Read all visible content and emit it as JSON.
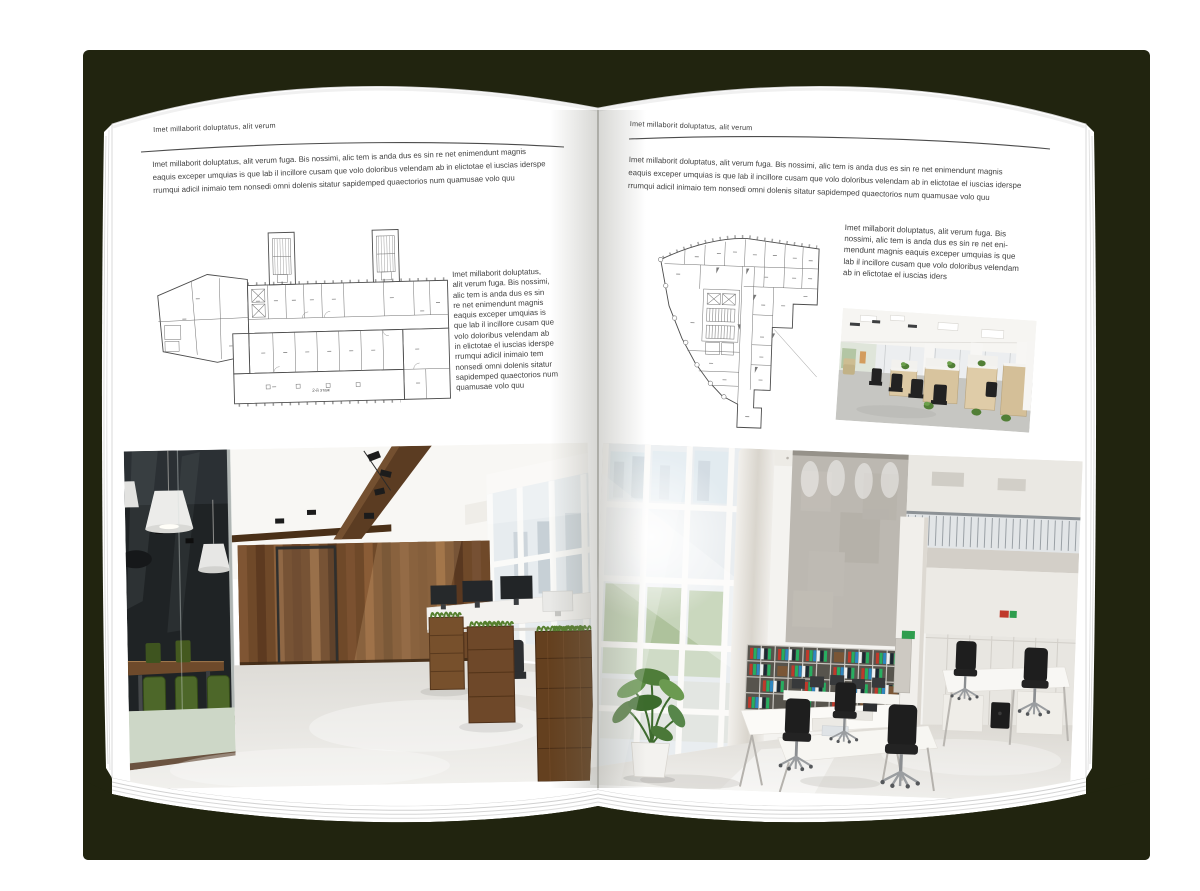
{
  "mockup": {
    "cover_color": "#21240f",
    "page_color": "#ffffff",
    "background_color": "#ffffff"
  },
  "left_page": {
    "header": "Imet millaborit doluptatus, alit verum",
    "intro_lines": [
      "Imet millaborit doluptatus, alit verum fuga. Bis nossimi, alic tem is anda dus es sin re net enimendunt magnis",
      "eaquis exceper umquias is que lab il incillore cusam que volo doloribus velendam ab in elictotae el iuscias iderspe",
      "rrumqui adicil inimaio tem nonsedi omni dolenis sitatur sapidemped quaectorios num quamusae volo quu"
    ],
    "floor_plan_caption": "2-й этаж",
    "side_text_lines": [
      "Imet millaborit doluptatus,",
      "alit verum fuga. Bis nossimi,",
      "alic tem is anda dus es sin",
      "re net enimendunt magnis",
      "eaquis exceper umquias is",
      "que lab il incillore cusam que",
      "volo doloribus velendam ab",
      "in elictotae el iuscias iderspe",
      "rrumqui adicil inimaio tem",
      "nonsedi omni dolenis sitatur",
      "sapidemped quaectorios num",
      "quamusae volo quu"
    ],
    "photo_label": "office-interior-wood-and-glass"
  },
  "right_page": {
    "header": "Imet millaborit doluptatus, alit verum",
    "intro_lines": [
      "Imet millaborit doluptatus, alit verum fuga. Bis nossimi, alic tem is anda dus es sin re net enimendunt magnis",
      "eaquis exceper umquias is que lab il incillore cusam que volo doloribus velendam ab in elictotae el iuscias iderspe",
      "rrumqui adicil inimaio tem nonsedi omni dolenis sitatur sapidemped quaectorios num quamusae volo quu"
    ],
    "side_text_lines": [
      "Imet millaborit doluptatus, alit verum fuga. Bis",
      "nossimi, alic tem is anda dus es sin re net eni-",
      "mendunt magnis eaquis exceper umquias is que",
      "lab il incillore cusam que volo doloribus velendam",
      "ab in elictotae el iuscias iders"
    ],
    "photo_small_label": "open-plan-office",
    "photo_label": "bright-atrium-office"
  }
}
